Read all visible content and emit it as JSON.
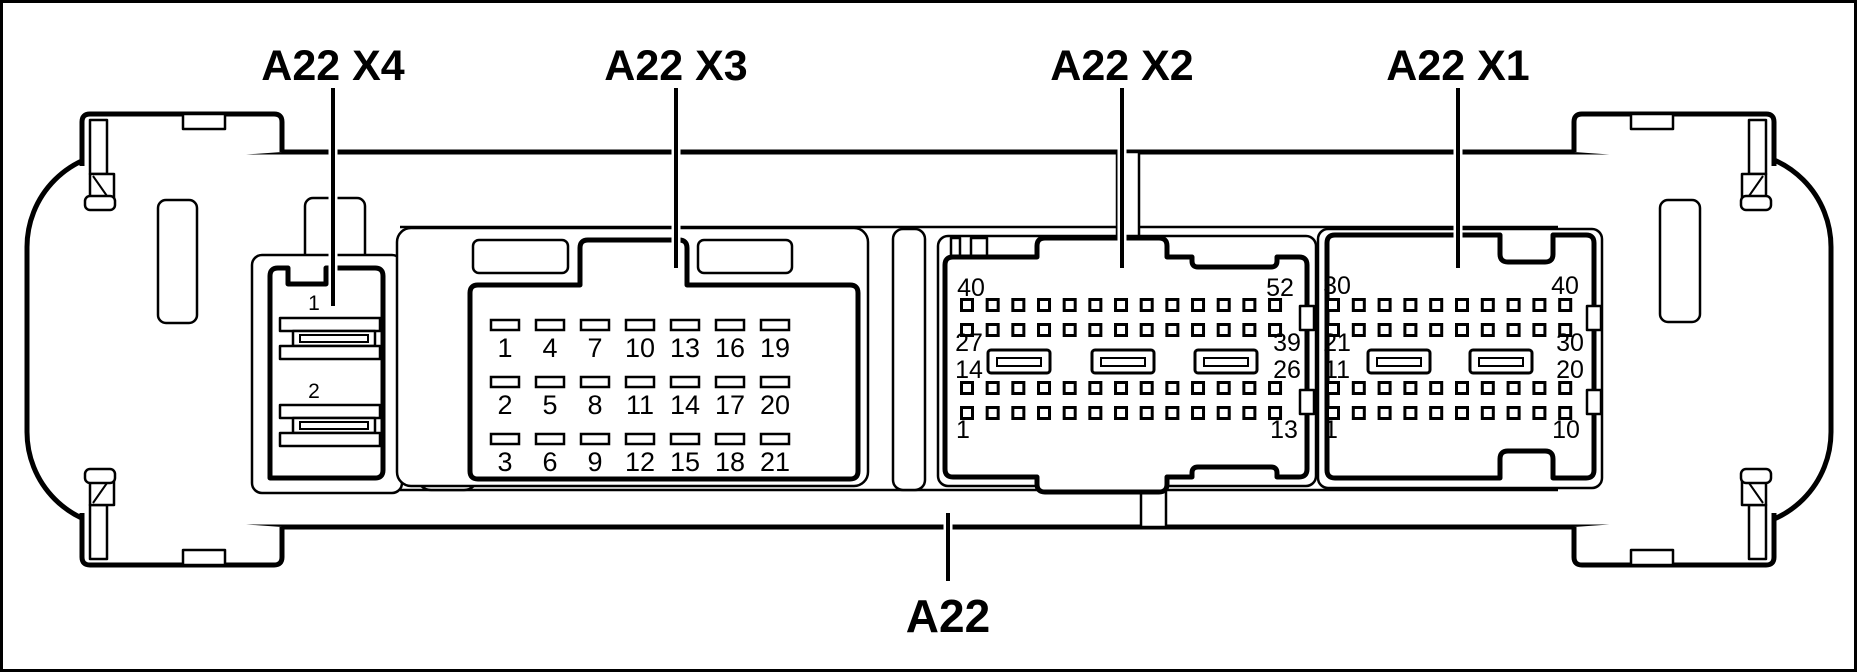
{
  "colors": {
    "ink": "#000000",
    "paper": "#ffffff"
  },
  "labels": {
    "x4": "A22 X4",
    "x3": "A22 X3",
    "x2": "A22 X2",
    "x1": "A22 X1",
    "module": "A22"
  },
  "x4": {
    "pins": [
      "1",
      "2"
    ]
  },
  "x3": {
    "grid": {
      "rows": 3,
      "cols": 7
    },
    "numbers": [
      [
        "1",
        "2",
        "3"
      ],
      [
        "4",
        "5",
        "6"
      ],
      [
        "7",
        "8",
        "9"
      ],
      [
        "10",
        "11",
        "12"
      ],
      [
        "13",
        "14",
        "15"
      ],
      [
        "16",
        "17",
        "18"
      ],
      [
        "19",
        "20",
        "21"
      ]
    ]
  },
  "x2": {
    "grid": {
      "rows": 4,
      "cols": 13
    },
    "slots": 3,
    "corner_labels": {
      "top_left": "40",
      "top_right": "52",
      "mid_left_top": "27",
      "mid_left_bottom": "14",
      "mid_right_top": "39",
      "mid_right_bottom": "26",
      "bottom_left": "1",
      "bottom_right": "13"
    }
  },
  "x1": {
    "grid": {
      "rows": 4,
      "cols": 10
    },
    "slots": 2,
    "corner_labels": {
      "top_left": "30",
      "top_right": "40",
      "mid_left_top": "21",
      "mid_left_bottom": "11",
      "mid_right_top": "30",
      "mid_right_bottom": "20",
      "bottom_left": "1",
      "bottom_right": "10"
    }
  }
}
